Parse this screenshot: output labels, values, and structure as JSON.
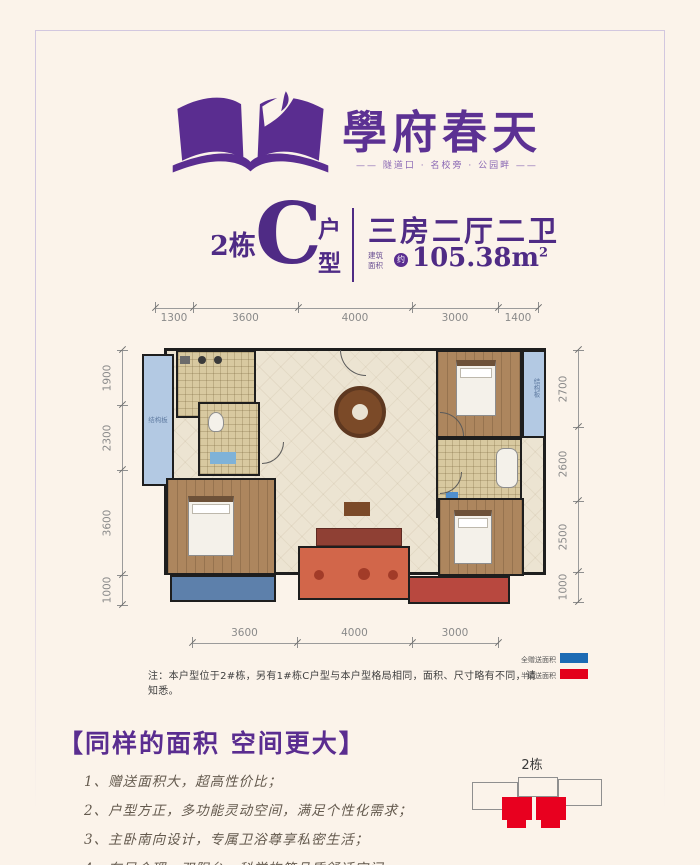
{
  "brand": {
    "logo_icon": "open-book-icon",
    "name": "學府春天",
    "tagline": "—— 隧道口 · 名校旁 · 公园畔 ——",
    "purple": "#5a2d90"
  },
  "unit": {
    "building": "2栋",
    "type_letter": "C",
    "type_word_top": "户",
    "type_word_bottom": "型",
    "layout": "三房二厅二卫",
    "area_label_top": "建筑",
    "area_label_bottom": "面积",
    "area_circle": "约",
    "area_value": "105.38m",
    "area_exponent": "2"
  },
  "floorplan": {
    "dims_top": [
      "1300",
      "3600",
      "4000",
      "3000",
      "1400"
    ],
    "dims_left": [
      "1900",
      "2300",
      "3600",
      "1000"
    ],
    "dims_right": [
      "2700",
      "2600",
      "2500",
      "1000"
    ],
    "dims_bottom": [
      "3600",
      "4000",
      "3000"
    ],
    "structural_label_left": "结构板",
    "structural_label_right": "结构板"
  },
  "legend": {
    "full_gift_label": "全赠送面积",
    "full_gift_color": "#1d6bb4",
    "half_gift_label": "半赠送面积",
    "half_gift_color": "#e3001b"
  },
  "note": "注：本户型位于2#栋，另有1#栋C户型与本户型格局相同，面积、尺寸略有不同，请知悉。",
  "selling_points": {
    "title": "【同样的面积 空间更大】",
    "items": [
      "1、赠送面积大，超高性价比；",
      "2、户型方正，多功能灵动空间，满足个性化需求；",
      "3、主卧南向设计，专属卫浴尊享私密生活；",
      "4、布局合理，双阳台，科学构筑品质舒适空间。"
    ]
  },
  "locator": {
    "building_label": "2栋"
  }
}
